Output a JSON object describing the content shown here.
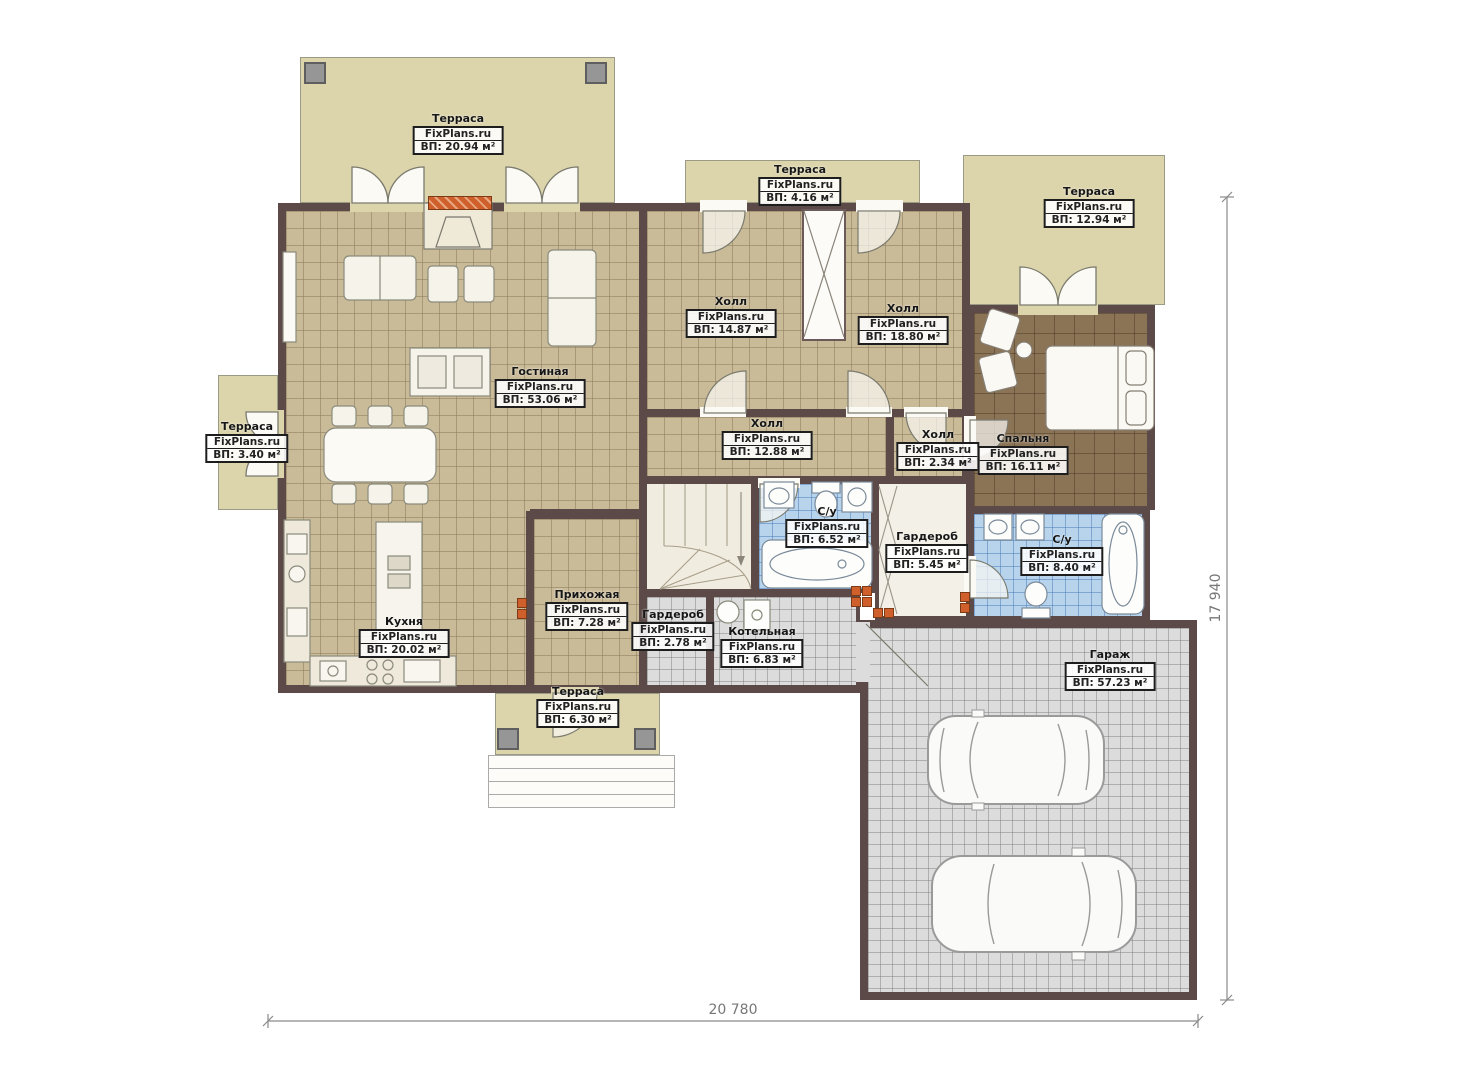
{
  "plan": {
    "watermark": "FixPlans.ru",
    "rooms": [
      {
        "id": "terrace-top-left",
        "name": "Терраса",
        "area": "ВП: 20.94 м²"
      },
      {
        "id": "terrace-top-middle",
        "name": "Терраса",
        "area": "ВП: 4.16 м²"
      },
      {
        "id": "terrace-top-right",
        "name": "Терраса",
        "area": "ВП: 12.94 м²"
      },
      {
        "id": "hall-north-west",
        "name": "Холл",
        "area": "ВП: 14.87 м²"
      },
      {
        "id": "hall-north-east",
        "name": "Холл",
        "area": "ВП: 18.80 м²"
      },
      {
        "id": "living-room",
        "name": "Гостиная",
        "area": "ВП: 53.06 м²"
      },
      {
        "id": "terrace-left",
        "name": "Терраса",
        "area": "ВП: 3.40 м²"
      },
      {
        "id": "hall-central",
        "name": "Холл",
        "area": "ВП: 12.88 м²"
      },
      {
        "id": "hall-small",
        "name": "Холл",
        "area": "ВП: 2.34 м²"
      },
      {
        "id": "bedroom",
        "name": "Спальня",
        "area": "ВП: 16.11 м²"
      },
      {
        "id": "bathroom-1",
        "name": "С/у",
        "area": "ВП: 6.52 м²"
      },
      {
        "id": "wardrobe-1",
        "name": "Гардероб",
        "area": "ВП: 5.45 м²"
      },
      {
        "id": "bathroom-2",
        "name": "С/у",
        "area": "ВП: 8.40 м²"
      },
      {
        "id": "entrance-hall",
        "name": "Прихожая",
        "area": "ВП: 7.28 м²"
      },
      {
        "id": "kitchen",
        "name": "Кухня",
        "area": "ВП: 20.02 м²"
      },
      {
        "id": "wardrobe-2",
        "name": "Гардероб",
        "area": "ВП: 2.78 м²"
      },
      {
        "id": "boiler-room",
        "name": "Котельная",
        "area": "ВП: 6.83 м²"
      },
      {
        "id": "garage",
        "name": "Гараж",
        "area": "ВП: 57.23 м²"
      },
      {
        "id": "terrace-bottom",
        "name": "Терраса",
        "area": "ВП: 6.30 м²"
      }
    ],
    "dimensions": {
      "bottom": "20 780",
      "right": "17 940"
    },
    "colors": {
      "wall": "#5c4a48",
      "tile_beige": "#cabb98",
      "tile_blue": "#b7d4ec",
      "tile_gray": "#dcdcdc",
      "floor_brown": "#8b7355",
      "terrace": "#dcd4ab",
      "accent_orange": "#cf5f2b"
    }
  }
}
